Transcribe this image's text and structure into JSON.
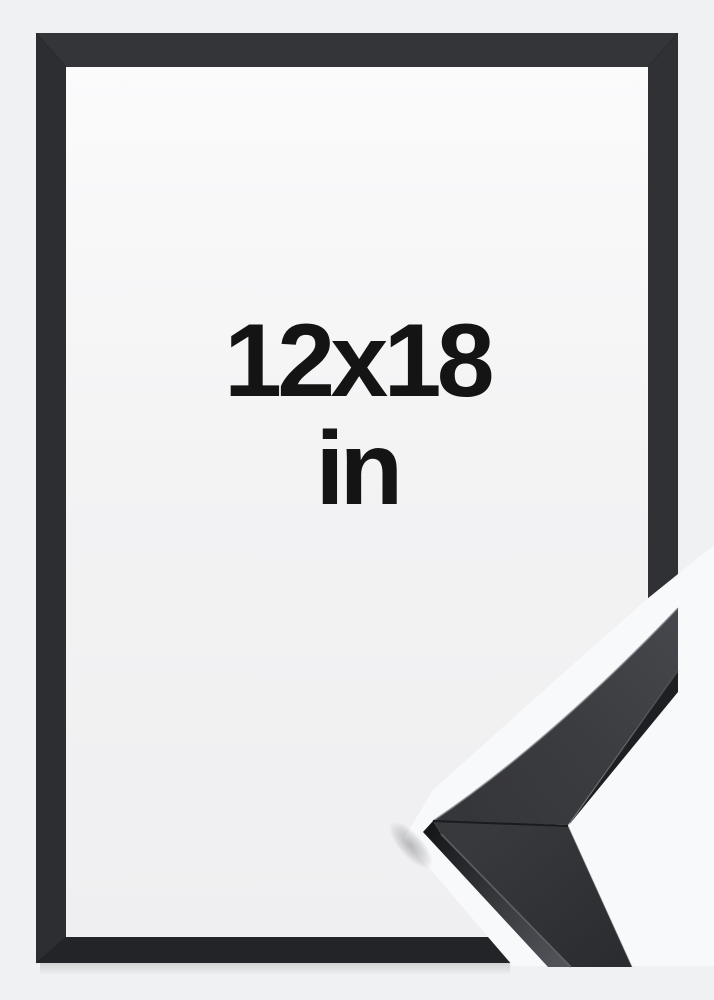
{
  "product": {
    "size_label_line1": "12x18",
    "size_label_line2": "in"
  },
  "colors": {
    "page_bg": "#f0f1f2",
    "photo_bg": "#f8f9fa",
    "interior_top": "#fbfbfc",
    "interior_bottom": "#efeff1",
    "frame_top": "#343539",
    "frame_left": "#2d2e32",
    "frame_right": "#303135",
    "frame_bottom": "#232428",
    "moulding_strip": "#1e1f22",
    "text": "#141414"
  }
}
